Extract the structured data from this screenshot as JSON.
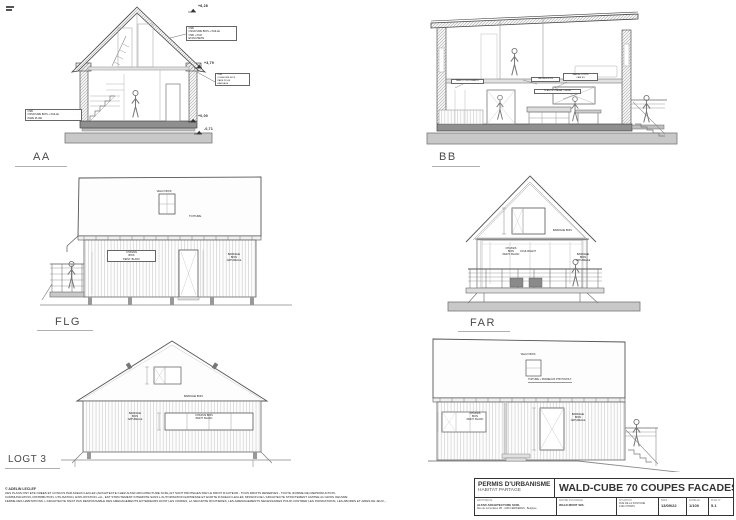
{
  "captions": {
    "aa": "AA",
    "bb": "BB",
    "flg": "FLG",
    "far": "FAR",
    "logt3": "LOGT 3"
  },
  "aa": {
    "levels": {
      "ridge": "+6,28",
      "eave": "+3,79",
      "floor": "+0,00",
      "ground": "-0,71"
    },
    "ann_roof": [
      "OSB",
      "OSSATURE BOIS + PAILLE",
      "OSB + PUR",
      "ETANCHEITE"
    ],
    "ann_wall_right": [
      "OSB",
      "OSSATURE BOIS",
      "PARE PLUIE",
      "BARDAGE"
    ],
    "ann_wall_left": [
      "OSB",
      "OSSATURE BOIS + PAILLE",
      "PARE PLUIE"
    ]
  },
  "bb": {
    "ann1": "PAROI COULISSANTE",
    "ann2": "MEUBLE BOIS",
    "ann3": [
      "GARDE-CORPS",
      "CABLES"
    ],
    "ann4": "PLAN DE TRAVAIL CHENE"
  },
  "labels": {
    "velux": "VELUX BOIS",
    "toiture": "TOITURE",
    "roof_pv": "TOITURE + PANNEAUX PHOTOVOLT.",
    "chassis": [
      "CHASSIS",
      "BOIS",
      "PEINT. BLANC"
    ],
    "chassis2": [
      "CHASSIS BOIS",
      "PEINT. BLANC"
    ],
    "coulissant": "COULISSANT",
    "bardage": [
      "BARDAGE",
      "BOIS",
      "NATURELLE"
    ],
    "bardage_bois": "BARDAGE BOIS"
  },
  "titleblock": {
    "permit": "PERMIS D'URBANISME",
    "project": "HABITAT PARTAGE",
    "title": "WALD-CUBE 70 COUPES FACADES",
    "cols": [
      {
        "h": "ARCHITECTE",
        "v1": "ALTAR ARCHITECTURE SCRL",
        "v2": "Rue de la Fontaine 2B - 4190 FERRIERES - Belgique"
      },
      {
        "h": "MAITRE D'OUVRAGE",
        "v1": "WALD MONT SRL",
        "v2": ""
      },
      {
        "h": "SITUATION",
        "v1": "RUE DE LA FONTAINE",
        "v2": "4190 XHORIS"
      },
      {
        "h": "DATE",
        "v1": "13/09/22",
        "v2": ""
      },
      {
        "h": "ECHELLE",
        "v1": "1/100",
        "v2": ""
      },
      {
        "h": "PLAN N°",
        "v1": "5.1",
        "v2": ""
      }
    ]
  },
  "legal": {
    "copyright": "© ADELIN LECLEF",
    "l1": "CES PLANS ONT ETE CREES ET CONCUS PAR ADELIN LECLEF (ARCHITECTE CHEZ ALTAR ARCHITECTURE SCRL) ET SONT PROTEGES PAR LE DROIT D'AUTEUR - TOUS DROITS RESERVES - TOUTE (FORME DE) REPRODUCTION,",
    "l2": "COMMUNICATION, DISTRIBUTION, UTILISATION, EXPLOITATION, etc., EST STRICTEMENT INTERDITE SANS L'AUTORISATION EXPRESSE ET ECRITE D'ADELIN LECLEF. MISSION DE L'ARCHITECTE STRICTEMENT LIMITEE AU GROS OEUVRE",
    "l3": "FERME DES HABITATIONS. L'ARCHITECTE N'EST PAS RESPONSABLE DES AMENAGEMENTS EXTERIEURS DONT LES VOIRIES, LA SECURITE ROUTIERES, LES AMENAGEMENTS NECESSAIRES POUR CONTRER LES INONDATIONS, LES ABORDS ET AIRES DE JEUX,..."
  }
}
